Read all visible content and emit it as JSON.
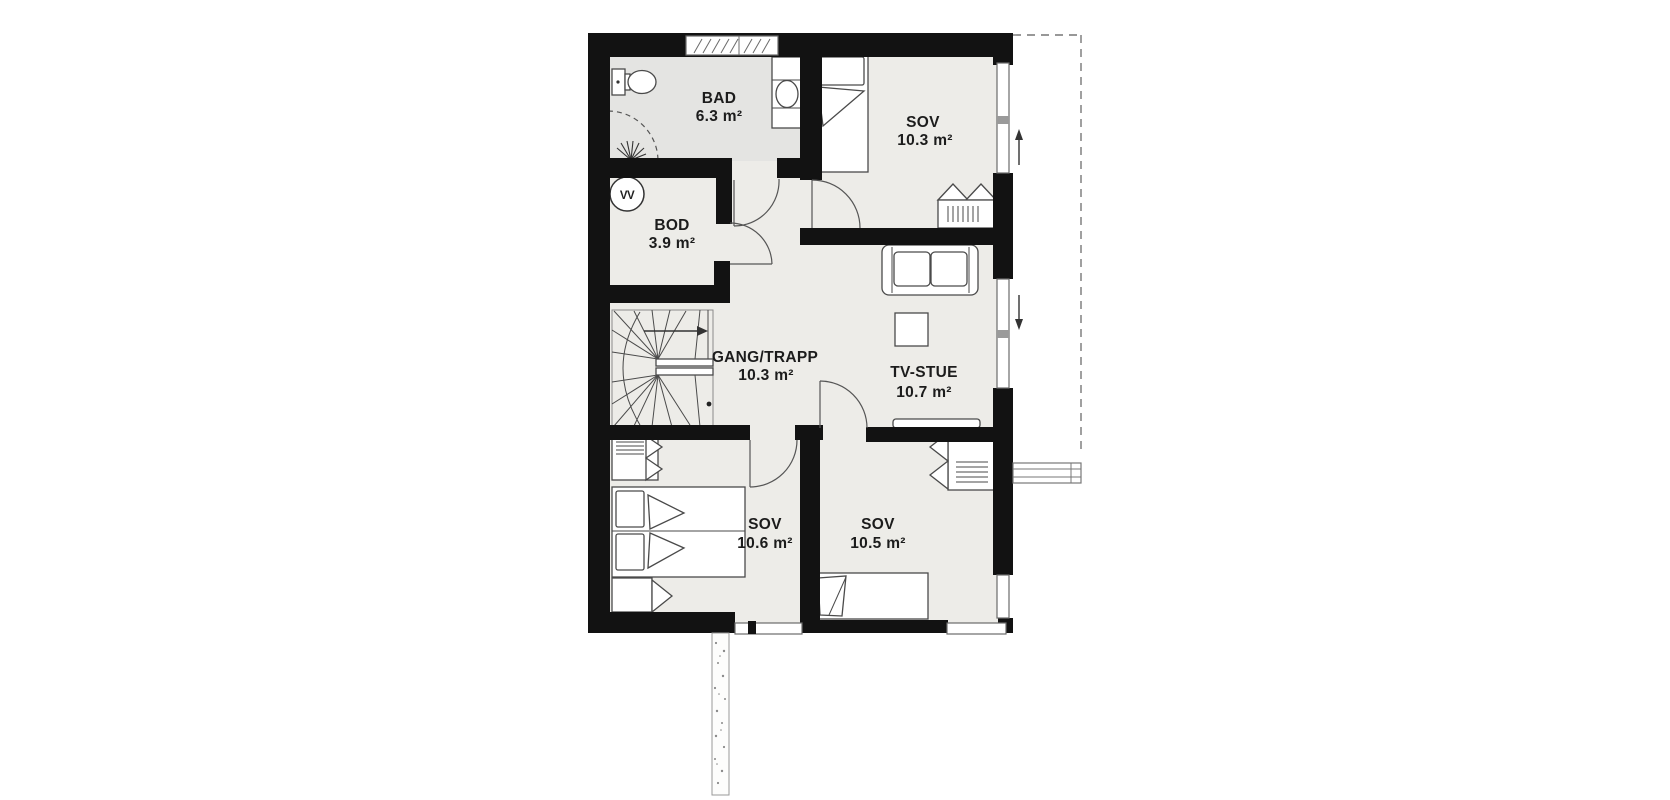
{
  "floorplan": {
    "rooms": [
      {
        "id": "bad",
        "name": "BAD",
        "area": "6.3 m²"
      },
      {
        "id": "sov-ne",
        "name": "SOV",
        "area": "10.3 m²"
      },
      {
        "id": "bod",
        "name": "BOD",
        "area": "3.9 m²"
      },
      {
        "id": "gang",
        "name": "GANG/TRAPP",
        "area": "10.3 m²"
      },
      {
        "id": "tvstue",
        "name": "TV-STUE",
        "area": "10.7 m²"
      },
      {
        "id": "sov-sw",
        "name": "SOV",
        "area": "10.6 m²"
      },
      {
        "id": "sov-se",
        "name": "SOV",
        "area": "10.5 m²"
      }
    ],
    "water_heater_label": "VV",
    "colors": {
      "wall": "#121212",
      "floor": "#edece8",
      "bathroom_floor": "#e4e4e2",
      "outline": "#4a4a4a",
      "background": "#ffffff"
    }
  }
}
